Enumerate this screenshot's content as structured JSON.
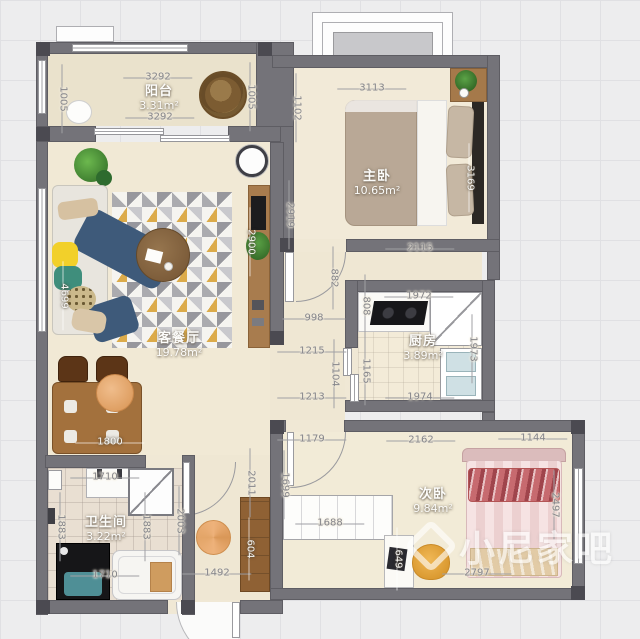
{
  "watermark": {
    "text": "小尼家吧"
  },
  "rooms": {
    "balcony": {
      "name": "阳台",
      "area": "3.31m²"
    },
    "living": {
      "name": "客餐厅",
      "area": "19.78m²"
    },
    "master": {
      "name": "主卧",
      "area": "10.65m²"
    },
    "kitchen": {
      "name": "厨房",
      "area": "3.89m²"
    },
    "bath": {
      "name": "卫生间",
      "area": "3.22m²"
    },
    "second": {
      "name": "次卧",
      "area": "9.84m²"
    }
  },
  "dims": {
    "balcony_top": "3292",
    "balcony_bottom": "3292",
    "balcony_left": "1005",
    "balcony_right": "1005",
    "master_top": "3113",
    "master_left_upper": "1102",
    "master_left_lower": "2919",
    "master_right": "3169",
    "master_bottom": "2115",
    "living_left": "4699",
    "living_right": "2900",
    "dining": "1800",
    "hall_upper": "882",
    "hall_door": "998",
    "hall_mid1": "1215",
    "hall_mid2": "1104",
    "hall_mid3": "1213",
    "hall_lower": "2011",
    "kitchen_top": "1972",
    "kitchen_left_upper": "808",
    "kitchen_left_lower": "1165",
    "kitchen_right": "1973",
    "kitchen_bottom": "1974",
    "bath_top": "1710",
    "bath_left": "1883",
    "bath_right": "1883",
    "bath_bottom": "1710",
    "corridor": "2003",
    "entry": "1492",
    "entry_cabinet": "604",
    "second_top_left": "1179",
    "second_top": "2162",
    "second_top_right": "1144",
    "second_left": "1699",
    "second_right": "2497",
    "second_bottom": "2797",
    "wardrobe": "1688",
    "desk": "649"
  },
  "colors": {
    "wall": "#747379",
    "floor": "#f1e9d5",
    "wood": "#a3713d",
    "sofa_navy": "#3e5a7a",
    "bed_pink": "#eed3d3",
    "dim_text": "#85858a"
  }
}
